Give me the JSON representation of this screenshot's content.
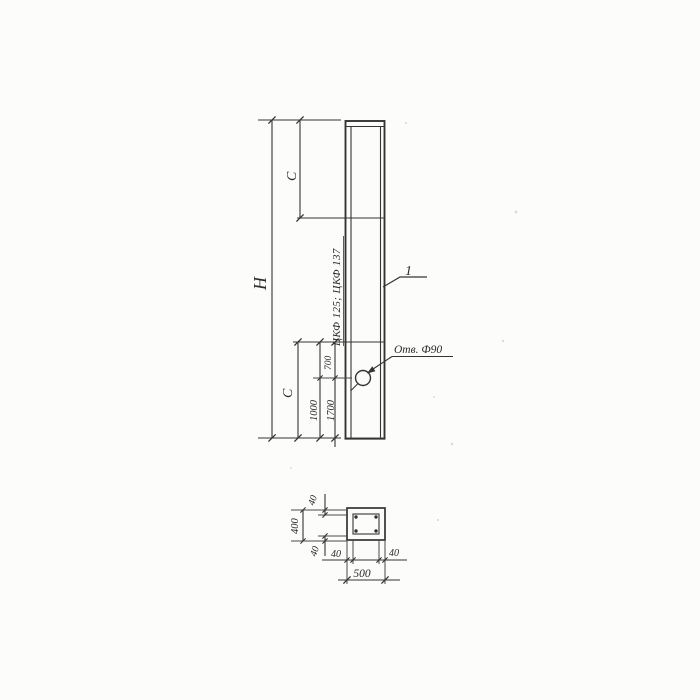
{
  "drawing_type": "engineering-drawing",
  "colors": {
    "ink": "#343434",
    "paper": "#fcfcfb"
  },
  "elevation": {
    "height_label": "Н",
    "segment_top_label": "С",
    "segment_bottom_label": "С",
    "dim_700": "700",
    "dim_1000": "1000",
    "dim_1700": "1700",
    "mark_text": "ЦКФ 125; ЦКФ 137",
    "position_number": "1",
    "hole_label": "Отв. Ф90"
  },
  "section": {
    "wall_top": "40",
    "height": "400",
    "wall_bottom": "40",
    "wall_left": "40",
    "wall_right": "40",
    "width": "500"
  }
}
